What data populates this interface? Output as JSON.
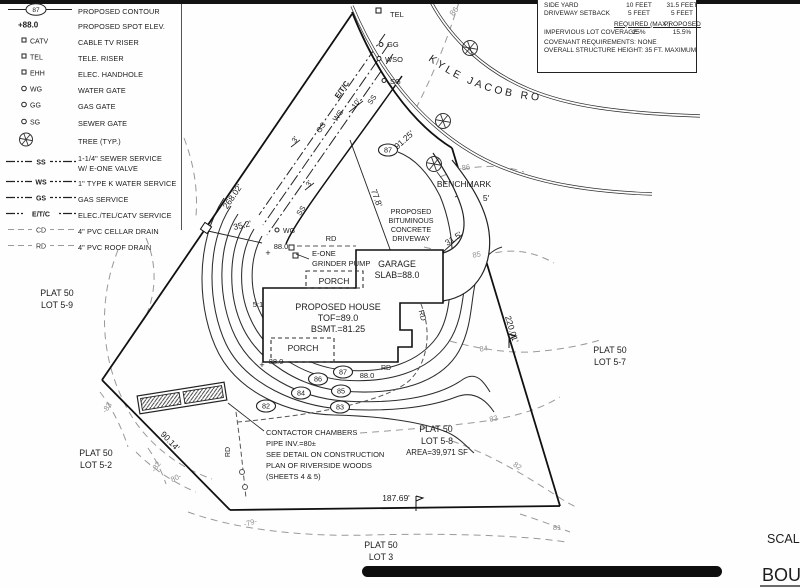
{
  "legend": {
    "items": [
      {
        "type": "contour",
        "sym": "87",
        "label": "PROPOSED CONTOUR"
      },
      {
        "type": "spot",
        "sym": "+88.0",
        "label": "PROPOSED SPOT ELEV."
      },
      {
        "type": "riser",
        "sym": "CATV",
        "label": "CABLE TV RISER"
      },
      {
        "type": "riser",
        "sym": "TEL",
        "label": "TELE. RISER"
      },
      {
        "type": "riser",
        "sym": "EHH",
        "label": "ELEC. HANDHOLE"
      },
      {
        "type": "gate",
        "sym": "WG",
        "label": "WATER GATE"
      },
      {
        "type": "gate",
        "sym": "GG",
        "label": "GAS GATE"
      },
      {
        "type": "gate",
        "sym": "SG",
        "label": "SEWER GATE"
      },
      {
        "type": "tree",
        "sym": "",
        "label": "TREE (TYP.)"
      },
      {
        "type": "service",
        "sym": "SS",
        "label": "1-1/4\" SEWER SERVICE",
        "label2": "W/ E-ONE VALVE"
      },
      {
        "type": "service",
        "sym": "WS",
        "label": "1\" TYPE K WATER SERVICE"
      },
      {
        "type": "service",
        "sym": "GS",
        "label": "GAS SERVICE"
      },
      {
        "type": "service",
        "sym": "E/T/C",
        "label": "ELEC./TEL/CATV SERVICE"
      },
      {
        "type": "drain",
        "sym": "CD",
        "label": "4\" PVC CELLAR DRAIN"
      },
      {
        "type": "drain",
        "sym": "RD",
        "label": "4\" PVC ROOF DRAIN"
      }
    ]
  },
  "setback_table": {
    "rows": [
      {
        "label": "SIDE YARD",
        "required": "10 FEET",
        "proposed": "31.5 FEET"
      },
      {
        "label": "DRIVEWAY SETBACK",
        "required": "5 FEET",
        "proposed": "5 FEET"
      }
    ],
    "col_headers": {
      "required": "REQUIRED (MAX.)",
      "proposed": "PROPOSED"
    },
    "coverage_row": {
      "label": "IMPERVIOUS LOT COVERAGE",
      "required": "25%",
      "proposed": "15.5%"
    },
    "notes": [
      "COVENANT REQUIREMENTS: NONE",
      "OVERALL STRUCTURE HEIGHT: 35 FT. MAXIMUM"
    ]
  },
  "road": {
    "name": "KYLE JACOB ROAD"
  },
  "colors": {
    "ink": "#1d1d1d",
    "gray": "#8f8f8f",
    "drain": "#555555"
  },
  "plan": {
    "labels": [
      {
        "t": "TEL",
        "x": 390,
        "y": 17,
        "s": 7.5,
        "a": "start"
      },
      {
        "t": "GG",
        "x": 387,
        "y": 47,
        "s": 7.5,
        "a": "start"
      },
      {
        "t": "WSO",
        "x": 385,
        "y": 62,
        "s": 7.5,
        "a": "start"
      },
      {
        "t": "SG",
        "x": 390,
        "y": 84,
        "s": 7.5,
        "a": "start"
      },
      {
        "t": "86",
        "x": 456,
        "y": 13,
        "r": -50,
        "s": 8,
        "c": "gray"
      },
      {
        "t": "91.25'",
        "x": 406,
        "y": 142,
        "r": -42,
        "s": 8.5
      },
      {
        "t": "BENCHMARK",
        "x": 464,
        "y": 187,
        "s": 8.5
      },
      {
        "t": "-86",
        "x": 465,
        "y": 170,
        "r": -8,
        "s": 7.5,
        "c": "gray"
      },
      {
        "t": "5'",
        "x": 486,
        "y": 201,
        "s": 8.5
      },
      {
        "t": "PROPOSED",
        "x": 411,
        "y": 214,
        "s": 7.2
      },
      {
        "t": "BITUMINOUS",
        "x": 411,
        "y": 223,
        "s": 7.2
      },
      {
        "t": "CONCRETE",
        "x": 411,
        "y": 232,
        "s": 7.2
      },
      {
        "t": "DRIVEWAY",
        "x": 411,
        "y": 241,
        "s": 7.2
      },
      {
        "t": "77.8'",
        "x": 374,
        "y": 199,
        "r": 70,
        "s": 8.5
      },
      {
        "t": "31.5'",
        "x": 455,
        "y": 241,
        "r": -33,
        "s": 8.5
      },
      {
        "t": "E/T/C",
        "x": 344,
        "y": 91,
        "r": -55,
        "s": 7.5,
        "w": "bold"
      },
      {
        "t": "SS",
        "x": 374,
        "y": 101,
        "r": -55,
        "s": 7.5
      },
      {
        "t": "10'",
        "x": 358,
        "y": 105,
        "r": -55,
        "s": 7.5
      },
      {
        "t": "WS",
        "x": 340,
        "y": 117,
        "r": -55,
        "s": 7.5
      },
      {
        "t": "GS",
        "x": 323,
        "y": 129,
        "r": -55,
        "s": 7.5
      },
      {
        "t": "3'",
        "x": 297,
        "y": 141,
        "r": -55,
        "s": 7.5
      },
      {
        "t": "3'",
        "x": 311,
        "y": 185,
        "r": -55,
        "s": 7.5
      },
      {
        "t": "SS",
        "x": 303,
        "y": 212,
        "r": -55,
        "s": 7.5
      },
      {
        "t": "WG",
        "x": 283,
        "y": 233,
        "s": 7,
        "a": "start"
      },
      {
        "t": "268.02'",
        "x": 235,
        "y": 198,
        "r": -56,
        "s": 8.5
      },
      {
        "t": "35.2'",
        "x": 243,
        "y": 228,
        "r": -13,
        "s": 8.5
      },
      {
        "t": "88.0",
        "x": 281,
        "y": 249,
        "s": 7.5
      },
      {
        "t": "+",
        "x": 268,
        "y": 256,
        "s": 9
      },
      {
        "t": "E-ONE",
        "x": 312,
        "y": 256,
        "s": 7.5,
        "a": "start"
      },
      {
        "t": "GRINDER PUMP",
        "x": 312,
        "y": 266,
        "s": 7.5,
        "a": "start"
      },
      {
        "t": "RD",
        "x": 331,
        "y": 241,
        "s": 7.5
      },
      {
        "t": "GARAGE",
        "x": 397,
        "y": 267,
        "s": 8.8
      },
      {
        "t": "SLAB=88.0",
        "x": 397,
        "y": 278,
        "s": 8.8
      },
      {
        "t": "PORCH",
        "x": 334,
        "y": 284,
        "s": 8.5
      },
      {
        "t": "PROPOSED HOUSE",
        "x": 338,
        "y": 310,
        "s": 9
      },
      {
        "t": "TOF=89.0",
        "x": 338,
        "y": 321,
        "s": 9
      },
      {
        "t": "BSMT.=81.25",
        "x": 338,
        "y": 332,
        "s": 9
      },
      {
        "t": "PORCH",
        "x": 303,
        "y": 351,
        "s": 8.5
      },
      {
        "t": "5:1",
        "x": 258,
        "y": 307,
        "s": 7.5
      },
      {
        "t": "RD",
        "x": 420,
        "y": 316,
        "r": 75,
        "s": 7.5
      },
      {
        "t": "88.0",
        "x": 276,
        "y": 364,
        "s": 7.5
      },
      {
        "t": "+",
        "x": 262,
        "y": 368,
        "s": 9
      },
      {
        "t": "88.0",
        "x": 367,
        "y": 378,
        "s": 7.5
      },
      {
        "t": "RD",
        "x": 386,
        "y": 370,
        "s": 7
      },
      {
        "t": "220.01'",
        "x": 509,
        "y": 330,
        "r": 73,
        "s": 8.5
      },
      {
        "t": "PLAT 50",
        "x": 610,
        "y": 353,
        "s": 8.8
      },
      {
        "t": "LOT 5-7",
        "x": 610,
        "y": 365,
        "s": 8.8
      },
      {
        "t": "85",
        "x": 477,
        "y": 257,
        "r": -10,
        "s": 7.5,
        "c": "gray"
      },
      {
        "t": "84",
        "x": 484,
        "y": 351,
        "r": -8,
        "s": 7.5,
        "c": "gray"
      },
      {
        "t": "83",
        "x": 494,
        "y": 421,
        "r": -12,
        "s": 7.5,
        "c": "gray"
      },
      {
        "t": "82",
        "x": 516,
        "y": 468,
        "r": 35,
        "s": 7.5,
        "c": "gray"
      },
      {
        "t": "81",
        "x": 557,
        "y": 530,
        "s": 7.5,
        "c": "gray"
      },
      {
        "t": "PLAT 50",
        "x": 436,
        "y": 432,
        "s": 8.8
      },
      {
        "t": "LOT 5-8",
        "x": 437,
        "y": 444,
        "s": 8.8
      },
      {
        "t": "AREA=39,971 SF",
        "x": 437,
        "y": 455,
        "s": 7.8
      },
      {
        "t": "CONTACTOR CHAMBERS",
        "x": 266,
        "y": 435,
        "s": 7.5,
        "a": "start"
      },
      {
        "t": "PIPE INV.=80±",
        "x": 266,
        "y": 446,
        "s": 7.5,
        "a": "start"
      },
      {
        "t": "SEE DETAIL ON CONSTRUCTION",
        "x": 266,
        "y": 457,
        "s": 7.5,
        "a": "start"
      },
      {
        "t": "PLAN OF RIVERSIDE WOODS",
        "x": 266,
        "y": 468,
        "s": 7.5,
        "a": "start"
      },
      {
        "t": "(SHEETS 4 & 5)",
        "x": 266,
        "y": 479,
        "s": 7.5,
        "a": "start"
      },
      {
        "t": "RD",
        "x": 230,
        "y": 452,
        "r": -90,
        "s": 7
      },
      {
        "t": "90.14'",
        "x": 168,
        "y": 443,
        "r": 46,
        "s": 8.5
      },
      {
        "t": "PLAT 50",
        "x": 96,
        "y": 456,
        "s": 8.8
      },
      {
        "t": "LOT 5-2",
        "x": 96,
        "y": 468,
        "s": 8.8
      },
      {
        "t": "-83",
        "x": 109,
        "y": 409,
        "r": -55,
        "s": 7.5,
        "c": "gray"
      },
      {
        "t": "-82",
        "x": 158,
        "y": 468,
        "r": -55,
        "s": 7.5,
        "c": "gray"
      },
      {
        "t": "80-",
        "x": 177,
        "y": 480,
        "r": -25,
        "s": 7.5,
        "c": "gray"
      },
      {
        "t": "187.69'",
        "x": 396,
        "y": 501,
        "s": 8.5
      },
      {
        "t": "-79-",
        "x": 251,
        "y": 525,
        "r": -15,
        "s": 7.5,
        "c": "gray"
      },
      {
        "t": "PLAT 50",
        "x": 381,
        "y": 548,
        "s": 8.8
      },
      {
        "t": "LOT 3",
        "x": 381,
        "y": 560,
        "s": 8.8
      },
      {
        "t": "PLAT 50",
        "x": 57,
        "y": 296,
        "s": 8.8
      },
      {
        "t": "LOT 5-9",
        "x": 57,
        "y": 308,
        "s": 8.8
      },
      {
        "t": "SCAL",
        "x": 767,
        "y": 543,
        "s": 12.5,
        "a": "start"
      },
      {
        "t": "BOU",
        "x": 762,
        "y": 581,
        "s": 18,
        "a": "start"
      }
    ],
    "bubbles": [
      {
        "t": "87",
        "x": 388,
        "y": 150
      },
      {
        "t": "87",
        "x": 343,
        "y": 372
      },
      {
        "t": "86",
        "x": 318,
        "y": 379
      },
      {
        "t": "85",
        "x": 341,
        "y": 391
      },
      {
        "t": "84",
        "x": 301,
        "y": 393
      },
      {
        "t": "83",
        "x": 340,
        "y": 407
      },
      {
        "t": "82",
        "x": 266,
        "y": 406
      }
    ],
    "trees": [
      {
        "x": 470,
        "y": 48
      },
      {
        "x": 443,
        "y": 121
      },
      {
        "x": 434,
        "y": 164
      }
    ]
  }
}
